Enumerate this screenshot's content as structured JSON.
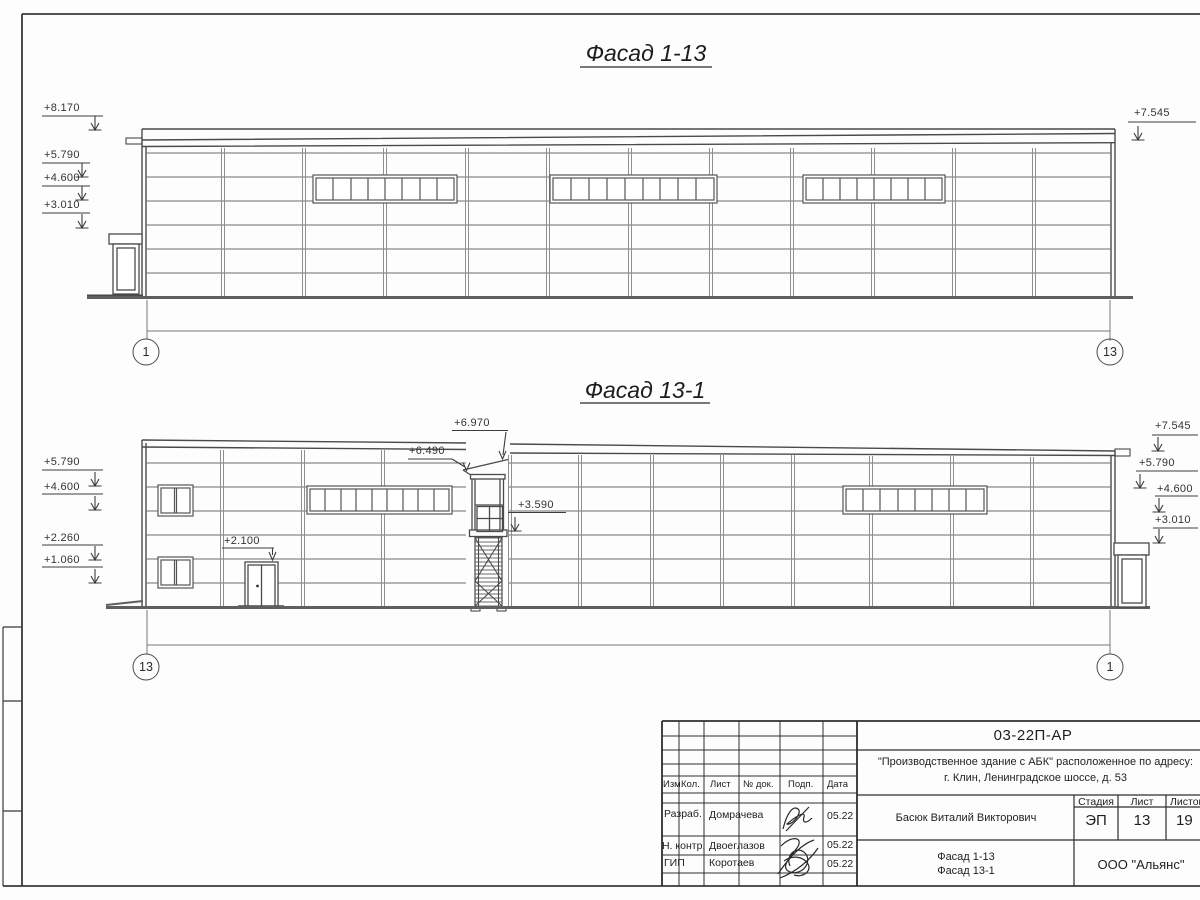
{
  "sheet": {
    "facade1": {
      "title": "Фасад 1-13",
      "grid_left": "1",
      "grid_right": "13",
      "levels_left": [
        "+8.170",
        "+5.790",
        "+4.600",
        "+3.010"
      ],
      "level_right": "+7.545"
    },
    "facade2": {
      "title": "Фасад 13-1",
      "grid_left": "13",
      "grid_right": "1",
      "levels_left": [
        "+5.790",
        "+4.600",
        "+2.260",
        "+1.060"
      ],
      "levels_inner": {
        "tower_top": "+6.970",
        "roof_edge": "+6.490",
        "tower_mid": "+3.590",
        "door_top": "+2.100"
      },
      "levels_right": [
        "+7.545",
        "+5.790",
        "+4.600",
        "+3.010"
      ]
    },
    "title_block": {
      "doc_number": "03-22П-АР",
      "object_line1": "\"Производственное здание с АБК\" расположенное по адресу:",
      "object_line2": "г. Клин, Ленинградское шоссе, д. 53",
      "rev_headers": [
        "Изм.",
        "Кол.",
        "Лист",
        "№ док.",
        "Подп.",
        "Дата"
      ],
      "rows": [
        {
          "role": "Разраб.",
          "name": "Домрачева",
          "date": "05.22"
        },
        {
          "role": "Н. контр.",
          "name": "Двоеглазов",
          "date": "05.22"
        },
        {
          "role": "ГИП",
          "name": "Коротаев",
          "date": "05.22"
        }
      ],
      "client": "Басюк Виталий Викторович",
      "stage_header": "Стадия",
      "sheet_header": "Лист",
      "sheets_header": "Листов",
      "stage": "ЭП",
      "sheet_no": "13",
      "sheets_total": "19",
      "sheet_title_line1": "Фасад 1-13",
      "sheet_title_line2": "Фасад 13-1",
      "company": "ООО \"Альянс\""
    }
  }
}
